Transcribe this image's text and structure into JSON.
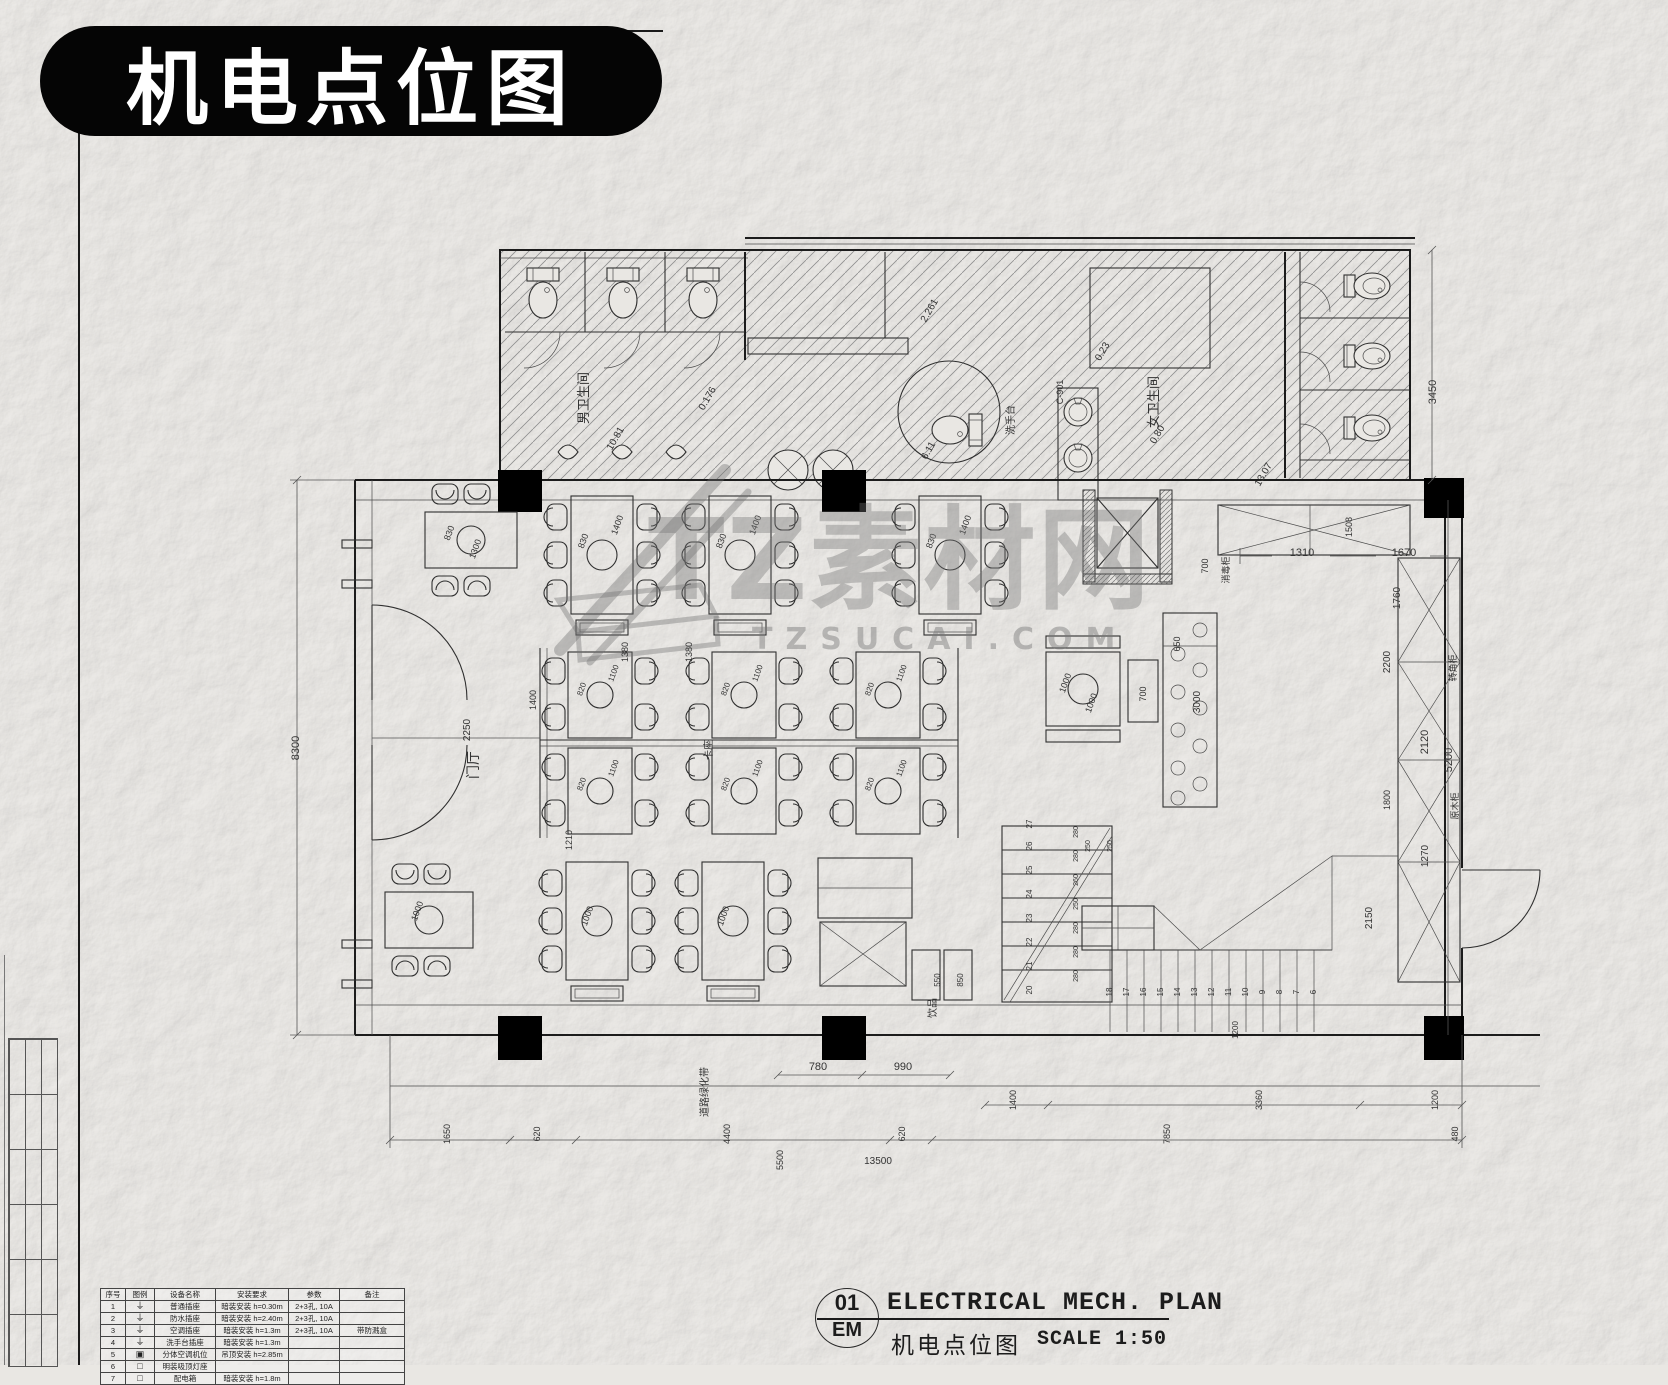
{
  "banner": {
    "title": "机电点位图"
  },
  "watermark": {
    "brand": "TZ素材网",
    "domain": "TZSUCAI.COM"
  },
  "title_block": {
    "number": "01",
    "discipline": "EM",
    "title_en": "ELECTRICAL MECH. PLAN",
    "title_zh": "机电点位图",
    "scale_label": "SCALE 1:50"
  },
  "legend": {
    "headers": [
      "序号",
      "图例",
      "设备名称",
      "安装要求",
      "参数",
      "备注"
    ],
    "rows": [
      {
        "no": "1",
        "icon": "⏚",
        "name": "普通插座",
        "install": "暗装安装 h=0.30m",
        "param": "2+3孔, 10A",
        "note": ""
      },
      {
        "no": "2",
        "icon": "⏚",
        "name": "防水插座",
        "install": "暗装安装 h=2.40m",
        "param": "2+3孔, 10A",
        "note": ""
      },
      {
        "no": "3",
        "icon": "⏚",
        "name": "空调插座",
        "install": "暗装安装 h=1.3m",
        "param": "2+3孔, 10A",
        "note": "带防溅盒"
      },
      {
        "no": "4",
        "icon": "⏚",
        "name": "洗手台插座",
        "install": "暗装安装 h=1.3m",
        "param": "",
        "note": ""
      },
      {
        "no": "5",
        "icon": "▣",
        "name": "分体空调机位",
        "install": "吊顶安装 h=2.85m",
        "param": "",
        "note": ""
      },
      {
        "no": "6",
        "icon": "□",
        "name": "明装吸顶灯座",
        "install": "",
        "param": "",
        "note": ""
      },
      {
        "no": "7",
        "icon": "□",
        "name": "配电箱",
        "install": "暗装安装 h=1.8m",
        "param": "",
        "note": ""
      }
    ]
  },
  "plan": {
    "labels": [
      {
        "t": "男卫生间",
        "x": 588,
        "y": 398,
        "r": -90,
        "s": 13
      },
      {
        "t": "女卫生间",
        "x": 1158,
        "y": 402,
        "r": -90,
        "s": 13
      },
      {
        "t": "洗手台",
        "x": 1014,
        "y": 420,
        "r": -90,
        "s": 10
      },
      {
        "t": "门厅",
        "x": 478,
        "y": 765,
        "r": -90,
        "s": 14
      },
      {
        "t": "卡座",
        "x": 712,
        "y": 750,
        "r": -90,
        "s": 10
      },
      {
        "t": "饮品",
        "x": 936,
        "y": 1008,
        "r": -90,
        "s": 10
      },
      {
        "t": "道路绿化带",
        "x": 708,
        "y": 1092,
        "r": -90,
        "s": 10
      },
      {
        "t": "消毒柜",
        "x": 1229,
        "y": 570,
        "r": -90,
        "s": 9
      },
      {
        "t": "C-901",
        "x": 1063,
        "y": 392,
        "r": -90,
        "s": 9
      },
      {
        "t": "转角柜",
        "x": 1456,
        "y": 668,
        "r": -90,
        "s": 9
      },
      {
        "t": "原木柜",
        "x": 1458,
        "y": 806,
        "r": -90,
        "s": 9
      },
      {
        "t": "10.81",
        "x": 618,
        "y": 440,
        "r": -60,
        "s": 10
      },
      {
        "t": "0.176",
        "x": 710,
        "y": 400,
        "r": -60,
        "s": 10
      },
      {
        "t": "2.261",
        "x": 932,
        "y": 312,
        "r": -60,
        "s": 10
      },
      {
        "t": "6.11",
        "x": 931,
        "y": 452,
        "r": -60,
        "s": 10
      },
      {
        "t": "0.23",
        "x": 1105,
        "y": 353,
        "r": -60,
        "s": 10
      },
      {
        "t": "0.80",
        "x": 1160,
        "y": 436,
        "r": -60,
        "s": 10
      },
      {
        "t": "13.07",
        "x": 1266,
        "y": 476,
        "r": -60,
        "s": 10
      },
      {
        "t": "8300",
        "x": 299,
        "y": 748,
        "r": -90,
        "s": 11
      },
      {
        "t": "2250",
        "x": 470,
        "y": 730,
        "r": -90,
        "s": 10
      },
      {
        "t": "3450",
        "x": 1436,
        "y": 392,
        "r": -90,
        "s": 11
      },
      {
        "t": "5200",
        "x": 1452,
        "y": 760,
        "r": -90,
        "s": 11
      },
      {
        "t": "1310",
        "x": 1302,
        "y": 556,
        "r": 0,
        "s": 11
      },
      {
        "t": "1670",
        "x": 1404,
        "y": 556,
        "r": 0,
        "s": 11
      },
      {
        "t": "1508",
        "x": 1352,
        "y": 527,
        "r": -90,
        "s": 9
      },
      {
        "t": "700",
        "x": 1208,
        "y": 566,
        "r": -90,
        "s": 9
      },
      {
        "t": "1760",
        "x": 1400,
        "y": 598,
        "r": -90,
        "s": 10
      },
      {
        "t": "2200",
        "x": 1390,
        "y": 662,
        "r": -90,
        "s": 10
      },
      {
        "t": "2120",
        "x": 1428,
        "y": 742,
        "r": -90,
        "s": 11
      },
      {
        "t": "1800",
        "x": 1390,
        "y": 800,
        "r": -90,
        "s": 9
      },
      {
        "t": "1270",
        "x": 1428,
        "y": 856,
        "r": -90,
        "s": 10
      },
      {
        "t": "650",
        "x": 1180,
        "y": 644,
        "r": -90,
        "s": 9
      },
      {
        "t": "3000",
        "x": 1200,
        "y": 702,
        "r": -90,
        "s": 10
      },
      {
        "t": "1380",
        "x": 628,
        "y": 652,
        "r": -90,
        "s": 9
      },
      {
        "t": "1380",
        "x": 692,
        "y": 652,
        "r": -90,
        "s": 9
      },
      {
        "t": "1400",
        "x": 536,
        "y": 700,
        "r": -90,
        "s": 9
      },
      {
        "t": "1210",
        "x": 572,
        "y": 840,
        "r": -90,
        "s": 9
      },
      {
        "t": "830",
        "x": 586,
        "y": 542,
        "r": -70,
        "s": 9
      },
      {
        "t": "1400",
        "x": 620,
        "y": 526,
        "r": -70,
        "s": 9
      },
      {
        "t": "830",
        "x": 724,
        "y": 542,
        "r": -70,
        "s": 9
      },
      {
        "t": "1400",
        "x": 758,
        "y": 526,
        "r": -70,
        "s": 9
      },
      {
        "t": "830",
        "x": 934,
        "y": 542,
        "r": -70,
        "s": 9
      },
      {
        "t": "1400",
        "x": 968,
        "y": 526,
        "r": -70,
        "s": 9
      },
      {
        "t": "830",
        "x": 452,
        "y": 534,
        "r": -70,
        "s": 9
      },
      {
        "t": "1300",
        "x": 478,
        "y": 550,
        "r": -70,
        "s": 9
      },
      {
        "t": "820",
        "x": 584,
        "y": 690,
        "r": -70,
        "s": 8
      },
      {
        "t": "1100",
        "x": 616,
        "y": 674,
        "r": -70,
        "s": 8
      },
      {
        "t": "820",
        "x": 728,
        "y": 690,
        "r": -70,
        "s": 8
      },
      {
        "t": "1100",
        "x": 760,
        "y": 674,
        "r": -70,
        "s": 8
      },
      {
        "t": "820",
        "x": 872,
        "y": 690,
        "r": -70,
        "s": 8
      },
      {
        "t": "1100",
        "x": 904,
        "y": 674,
        "r": -70,
        "s": 8
      },
      {
        "t": "820",
        "x": 584,
        "y": 785,
        "r": -70,
        "s": 8
      },
      {
        "t": "1100",
        "x": 616,
        "y": 769,
        "r": -70,
        "s": 8
      },
      {
        "t": "820",
        "x": 728,
        "y": 785,
        "r": -70,
        "s": 8
      },
      {
        "t": "1100",
        "x": 760,
        "y": 769,
        "r": -70,
        "s": 8
      },
      {
        "t": "820",
        "x": 872,
        "y": 785,
        "r": -70,
        "s": 8
      },
      {
        "t": "1100",
        "x": 904,
        "y": 769,
        "r": -70,
        "s": 8
      },
      {
        "t": "1000",
        "x": 420,
        "y": 912,
        "r": -70,
        "s": 9
      },
      {
        "t": "1000",
        "x": 590,
        "y": 917,
        "r": -70,
        "s": 9
      },
      {
        "t": "1000",
        "x": 726,
        "y": 917,
        "r": -70,
        "s": 9
      },
      {
        "t": "1000",
        "x": 1068,
        "y": 684,
        "r": -70,
        "s": 9
      },
      {
        "t": "1000",
        "x": 1094,
        "y": 704,
        "r": -70,
        "s": 9
      },
      {
        "t": "700",
        "x": 1146,
        "y": 694,
        "r": -90,
        "s": 9
      },
      {
        "t": "780",
        "x": 818,
        "y": 1070,
        "r": 0,
        "s": 11
      },
      {
        "t": "990",
        "x": 903,
        "y": 1070,
        "r": 0,
        "s": 11
      },
      {
        "t": "1400",
        "x": 1016,
        "y": 1100,
        "r": -90,
        "s": 9
      },
      {
        "t": "3360",
        "x": 1262,
        "y": 1100,
        "r": -90,
        "s": 9
      },
      {
        "t": "1200",
        "x": 1438,
        "y": 1100,
        "r": -90,
        "s": 9
      },
      {
        "t": "1650",
        "x": 450,
        "y": 1134,
        "r": -90,
        "s": 9
      },
      {
        "t": "620",
        "x": 540,
        "y": 1134,
        "r": -90,
        "s": 9
      },
      {
        "t": "4400",
        "x": 730,
        "y": 1134,
        "r": -90,
        "s": 9
      },
      {
        "t": "620",
        "x": 905,
        "y": 1134,
        "r": -90,
        "s": 9
      },
      {
        "t": "7850",
        "x": 1170,
        "y": 1134,
        "r": -90,
        "s": 9
      },
      {
        "t": "480",
        "x": 1458,
        "y": 1134,
        "r": -90,
        "s": 9
      },
      {
        "t": "5500",
        "x": 783,
        "y": 1160,
        "r": -90,
        "s": 9
      },
      {
        "t": "13500",
        "x": 878,
        "y": 1164,
        "r": 0,
        "s": 10
      },
      {
        "t": "20",
        "x": 1032,
        "y": 990,
        "r": -90,
        "s": 8
      },
      {
        "t": "21",
        "x": 1032,
        "y": 966,
        "r": -90,
        "s": 8
      },
      {
        "t": "22",
        "x": 1032,
        "y": 942,
        "r": -90,
        "s": 8
      },
      {
        "t": "23",
        "x": 1032,
        "y": 918,
        "r": -90,
        "s": 8
      },
      {
        "t": "24",
        "x": 1032,
        "y": 894,
        "r": -90,
        "s": 8
      },
      {
        "t": "25",
        "x": 1032,
        "y": 870,
        "r": -90,
        "s": 8
      },
      {
        "t": "26",
        "x": 1032,
        "y": 846,
        "r": -90,
        "s": 8
      },
      {
        "t": "27",
        "x": 1032,
        "y": 824,
        "r": -90,
        "s": 8
      },
      {
        "t": "280",
        "x": 1078,
        "y": 976,
        "r": -90,
        "s": 7
      },
      {
        "t": "280",
        "x": 1078,
        "y": 952,
        "r": -90,
        "s": 7
      },
      {
        "t": "280",
        "x": 1078,
        "y": 928,
        "r": -90,
        "s": 7
      },
      {
        "t": "250",
        "x": 1078,
        "y": 904,
        "r": -90,
        "s": 7
      },
      {
        "t": "260",
        "x": 1078,
        "y": 880,
        "r": -90,
        "s": 7
      },
      {
        "t": "280",
        "x": 1078,
        "y": 856,
        "r": -90,
        "s": 7
      },
      {
        "t": "280",
        "x": 1078,
        "y": 832,
        "r": -90,
        "s": 7
      },
      {
        "t": "18",
        "x": 1112,
        "y": 992,
        "r": -90,
        "s": 8
      },
      {
        "t": "17",
        "x": 1129,
        "y": 992,
        "r": -90,
        "s": 8
      },
      {
        "t": "16",
        "x": 1146,
        "y": 992,
        "r": -90,
        "s": 8
      },
      {
        "t": "15",
        "x": 1163,
        "y": 992,
        "r": -90,
        "s": 8
      },
      {
        "t": "14",
        "x": 1180,
        "y": 992,
        "r": -90,
        "s": 8
      },
      {
        "t": "13",
        "x": 1197,
        "y": 992,
        "r": -90,
        "s": 8
      },
      {
        "t": "12",
        "x": 1214,
        "y": 992,
        "r": -90,
        "s": 8
      },
      {
        "t": "11",
        "x": 1231,
        "y": 992,
        "r": -90,
        "s": 8
      },
      {
        "t": "10",
        "x": 1248,
        "y": 992,
        "r": -90,
        "s": 8
      },
      {
        "t": "9",
        "x": 1265,
        "y": 992,
        "r": -90,
        "s": 8
      },
      {
        "t": "8",
        "x": 1282,
        "y": 992,
        "r": -90,
        "s": 8
      },
      {
        "t": "7",
        "x": 1299,
        "y": 992,
        "r": -90,
        "s": 8
      },
      {
        "t": "6",
        "x": 1316,
        "y": 992,
        "r": -90,
        "s": 8
      },
      {
        "t": "2150",
        "x": 1372,
        "y": 918,
        "r": -90,
        "s": 10
      },
      {
        "t": "1200",
        "x": 1238,
        "y": 1030,
        "r": -90,
        "s": 8
      },
      {
        "t": "550",
        "x": 940,
        "y": 980,
        "r": -90,
        "s": 8
      },
      {
        "t": "850",
        "x": 963,
        "y": 980,
        "r": -90,
        "s": 8
      },
      {
        "t": "250",
        "x": 1090,
        "y": 846,
        "r": -90,
        "s": 7
      },
      {
        "t": "250",
        "x": 1112,
        "y": 846,
        "r": -90,
        "s": 7
      }
    ]
  }
}
